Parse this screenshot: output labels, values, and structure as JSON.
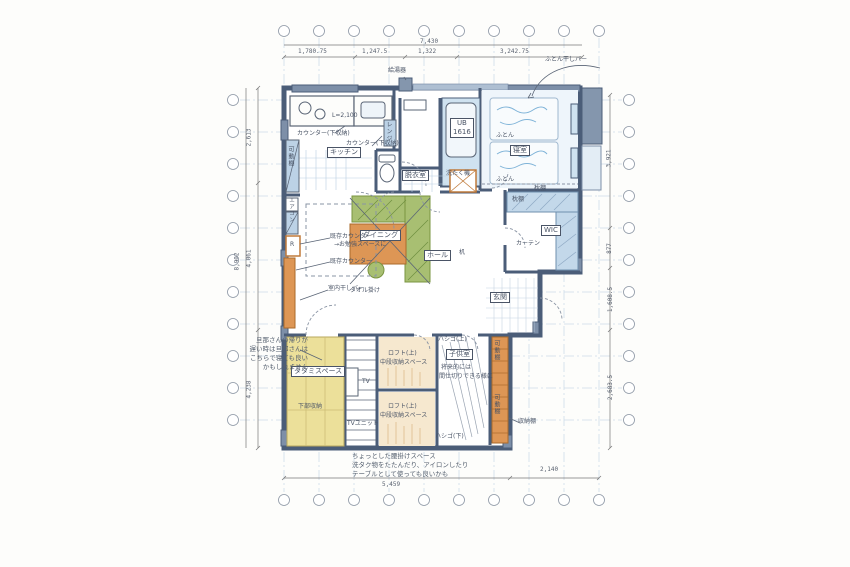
{
  "rooms": {
    "kitchen": "キッチン",
    "bath": "UB",
    "bath_size": "1616",
    "dressing": "脱衣室",
    "bedroom": "寝室",
    "wic": "WIC",
    "dining": "ダイニング",
    "hall": "ホール",
    "entrance": "玄関",
    "tatami": "タタミスペース",
    "kids": "子供室"
  },
  "fixtures": {
    "water_heater": "給湯器",
    "futon_drying_bar": "ふとん干しバー",
    "counter1": "カウンター(下収納)",
    "counter2": "カウンター(下収納)",
    "counter_length": "L=2,100",
    "range": "レンジ",
    "movable_shelf_left": "可動棚",
    "aircon": "エアコン",
    "fridge": "R",
    "washer": "洗たく機",
    "futon1": "ふとん",
    "futon2": "ふとん",
    "pillow_shelf_bedroom": "枕棚",
    "pillow_shelf_wic": "枕棚",
    "curtain": "カーテン",
    "desk": "机",
    "existing_counter_study1": "既存カウンター",
    "existing_counter_study2": "→お勉強スペースに",
    "existing_counter": "既存カウンター",
    "indoor_drying_bar": "室内干しバー",
    "towel_bar": "タオル掛け",
    "lower_storage": "下部収納",
    "tv": "TV",
    "tv_unit": "TVユニット",
    "loft_a": "ロフト(上)",
    "loft_a_sub": "中段収納スペース",
    "loft_b": "ロフト(上)",
    "loft_b_sub": "中段収納スペース",
    "kids_note1": "将来的には",
    "kids_note2": "間仕切りできる様に",
    "movable_shelf_a": "可動棚",
    "movable_shelf_b": "可動棚",
    "ladder_up": "ハシゴ(上)",
    "ladder_down": "ハシゴ(下)",
    "storage_shelf": "収納棚"
  },
  "annotations": {
    "nap_note": [
      "旦那さんの帰りが",
      "遅い時は旦那さんは",
      "こちらで寝ても良い",
      "かもしれません"
    ],
    "bench_note": [
      "ちょっとした腰掛けスペース",
      "洗タク物をたたんだり、アイロンしたり",
      "テーブルとして使っても良いかも"
    ]
  },
  "dimensions": {
    "top_total": "7,430",
    "top_segments": [
      "1,780.75",
      "1,247.5",
      "1,322",
      "3,242.75"
    ],
    "left_total": "8,902",
    "left_segments": [
      "2,613",
      "4,061",
      "4,238"
    ],
    "right_segments": [
      "3,921",
      "877",
      "1,608.5",
      "2,683.5"
    ],
    "bottom_segments": [
      "5,459",
      "2,140"
    ]
  },
  "colors": {
    "wall": "#4b5d78",
    "wood": "#dd9655",
    "bench_green": "#a8bf72",
    "tatami_yellow": "#ece09a",
    "water_blue": "#cfe2f0",
    "ink": "#4a5466"
  }
}
